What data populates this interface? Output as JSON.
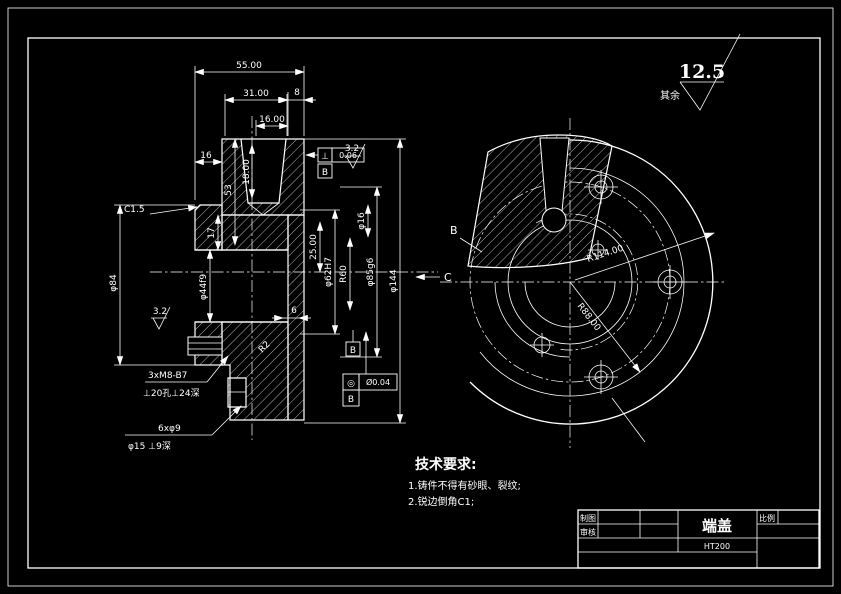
{
  "finish_note": {
    "others_label": "其余",
    "value": "12.5"
  },
  "section": {
    "dims": {
      "w55": "55.00",
      "w31": "31.00",
      "w16": "16.00",
      "t8": "8",
      "left16": "16",
      "h53": "53",
      "h18": "18.00",
      "h17": "17",
      "chamfer": "C1.5",
      "d84": "φ84",
      "d44": "φ44f9",
      "d25": "25.00",
      "d62": "φ62H7",
      "d16": "φ16",
      "r60": "R60",
      "d85": "φ85g6",
      "d144": "φ144",
      "t6": "6",
      "r2": "R2",
      "ra_left": "3.2",
      "ra_right": "3.2"
    },
    "fcf_perp": {
      "symbol": "⊥",
      "value": "0.06",
      "datum": "B"
    },
    "fcf_conc": {
      "symbol": "◎",
      "value": "Ø0.04",
      "datum": "B"
    },
    "datum_b": "B",
    "thread_callout": {
      "line1": "3xM8-B7",
      "line2": "⊥20孔⊥24深"
    },
    "hole_callout": {
      "line1": "6xφ9",
      "line2": "φ15 ⊥9深"
    },
    "view_c": "C"
  },
  "end_view": {
    "r114": "R114.00",
    "r88": "R88.00",
    "view_b": "B"
  },
  "tech_req": {
    "title": "技术要求:",
    "item1": "1.铸件不得有砂眼、裂纹;",
    "item2": "2.锐边倒角C1;"
  },
  "title_block": {
    "part": "端盖",
    "material": "HT200",
    "drawn": "制图",
    "checked": "审核",
    "scale": "比例"
  }
}
